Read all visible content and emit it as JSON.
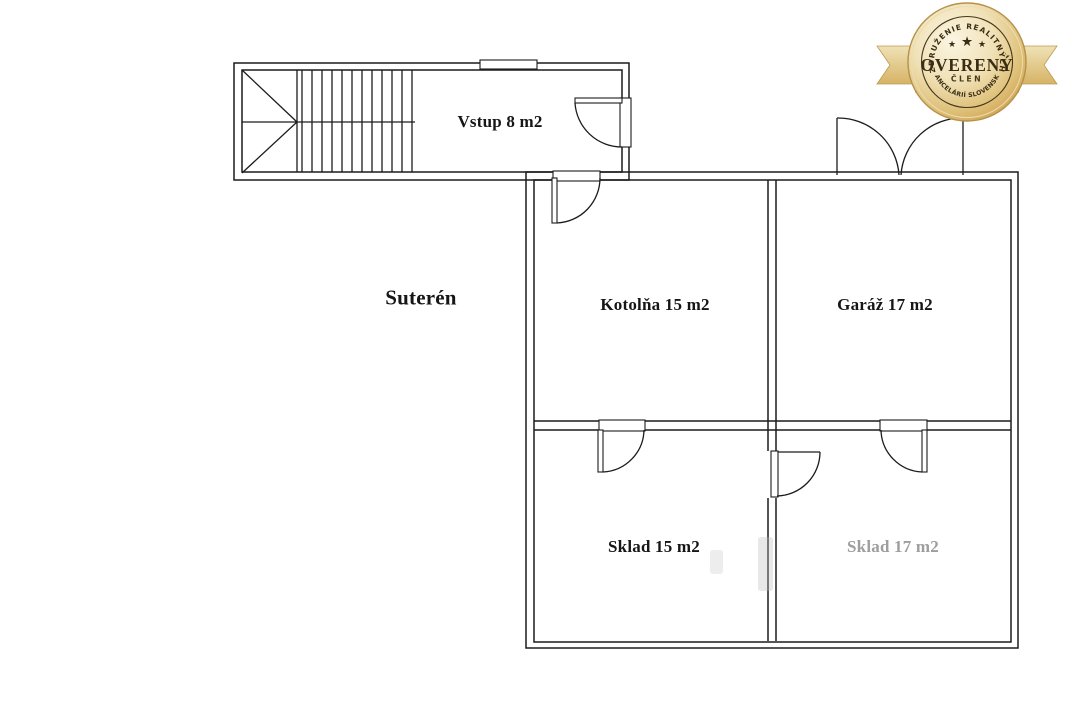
{
  "page": {
    "background": "#ffffff",
    "line_color": "#1c1c1c"
  },
  "plan": {
    "floor_label": "Suterén",
    "rooms": [
      {
        "id": "vstup",
        "label": "Vstup 8 m2"
      },
      {
        "id": "kotolna",
        "label": "Kotolňa 15 m2"
      },
      {
        "id": "garaz",
        "label": "Garáž 17 m2"
      },
      {
        "id": "sklad15",
        "label": "Sklad 15 m2"
      },
      {
        "id": "sklad17",
        "label": "Sklad 17 m2"
      }
    ]
  },
  "badge": {
    "top_text": "ZDRUŽENIE REALITNÝCH",
    "bottom_text": "KANCELÁRIÍ SLOVENSKA",
    "main_text": "OVERENÝ",
    "sub_text": "ČLEN",
    "star": "★",
    "colors": {
      "gold_light": "#fbf5e2",
      "gold_dark": "#ce9c4a",
      "ribbon": "#e7cf97",
      "text": "#3a2d14"
    }
  }
}
